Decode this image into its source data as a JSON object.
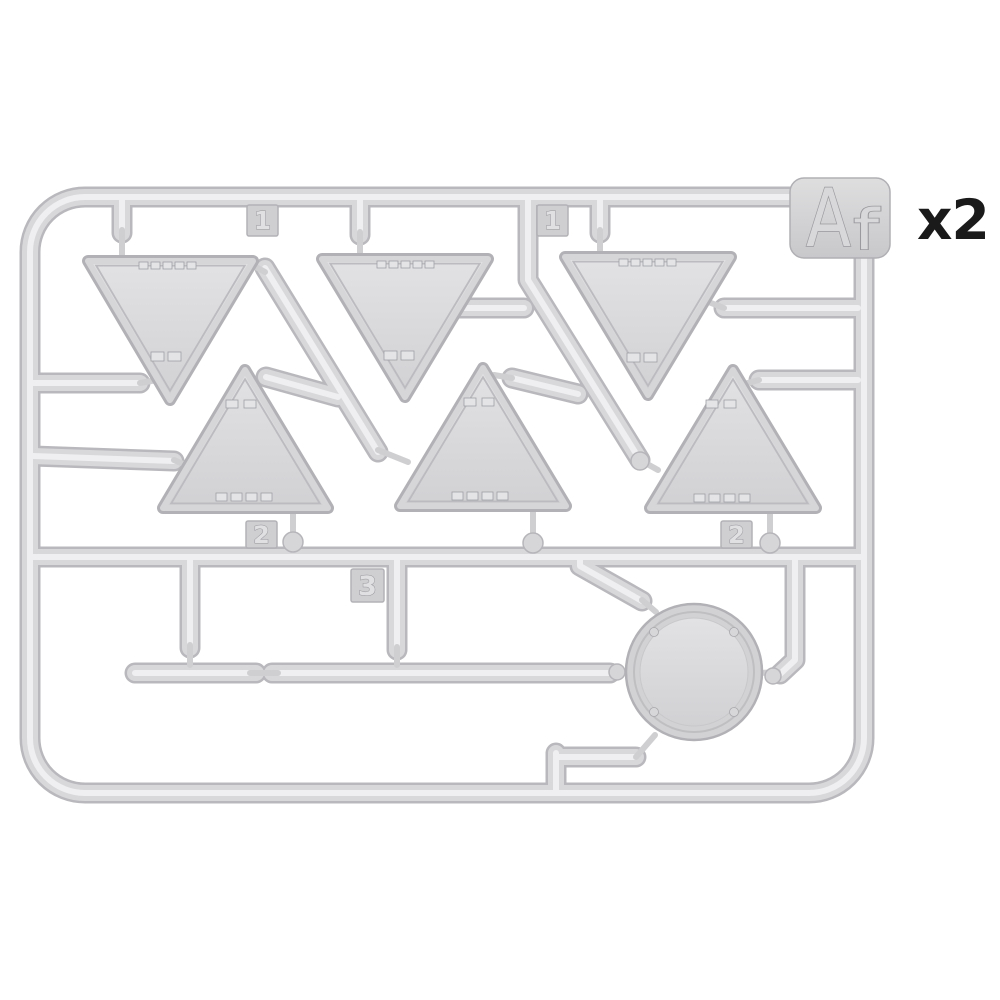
{
  "scene": {
    "background_color": "#ffffff",
    "description": "Photo of a light-gray injection-molded plastic sprue holding model road-sign parts",
    "quantity_label": "x2"
  },
  "sprue": {
    "id_plate": {
      "label": "Af",
      "letter_large": "A",
      "letter_small": "f"
    },
    "gate_tabs": [
      {
        "label": "1"
      },
      {
        "label": "1"
      },
      {
        "label": "2"
      },
      {
        "label": "2"
      },
      {
        "label": "3"
      }
    ],
    "parts": {
      "triangle_signs_pointing_down": 3,
      "triangle_signs_pointing_up": 3,
      "round_signs": 1
    },
    "colors": {
      "plastic_body": "#d8d8db",
      "plastic_highlight": "#efeff1",
      "plastic_edge": "#b9b9bd",
      "part_face": "#dadadd",
      "tab_face": "#cfcfd2",
      "quantity_text": "#1a1a1a"
    }
  }
}
